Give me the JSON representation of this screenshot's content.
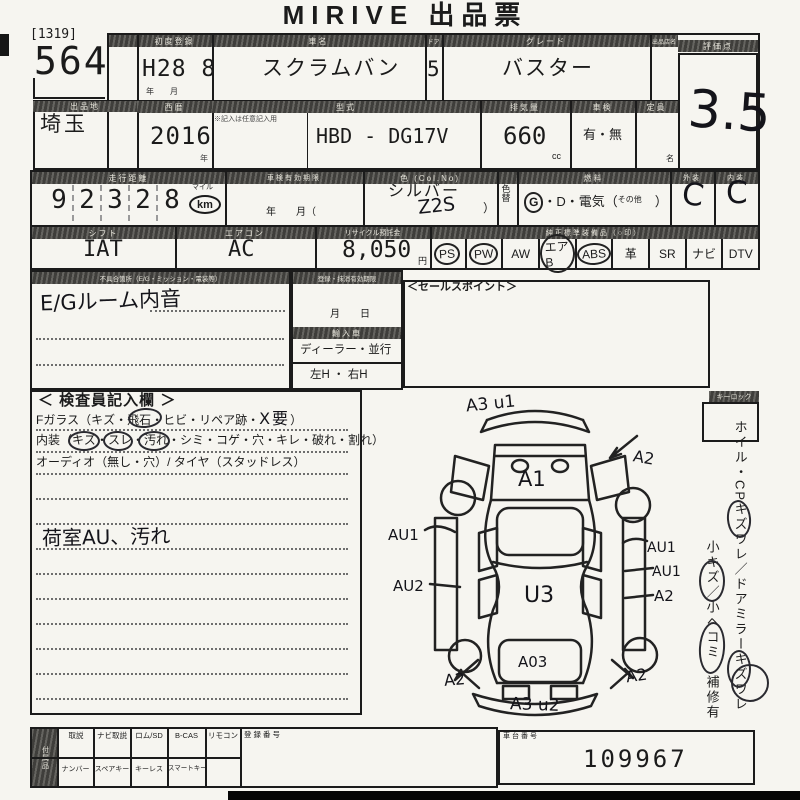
{
  "title": "MIRIVE 出品票",
  "lot": {
    "bracket": "[1319]",
    "number": "564",
    "prefecture_header": "出品地",
    "prefecture": "埼玉"
  },
  "row1": {
    "h_reg": "初度登録",
    "h_name": "車名",
    "h_door": "ドア",
    "h_grade": "グレード",
    "h_seller": "出品店名",
    "h_score": "評価点",
    "reg_value": "H28 8",
    "reg_sub": "年　　月",
    "name_value": "スクラムバン",
    "door_value": "5",
    "grade_value": "バスター",
    "score_value": "3.5"
  },
  "row2": {
    "h_year": "西暦",
    "h_model": "型式",
    "h_cc": "排気量",
    "h_shaken": "車検",
    "h_capacity": "定員",
    "year_value": "2016",
    "year_unit": "年",
    "model_note": "※記入は任意記入用",
    "model_value": "HBD -  DG17V",
    "cc_value": "660",
    "cc_unit": "cc",
    "shaken_value": "有・無",
    "capacity_unit": "名"
  },
  "row3": {
    "h_odo": "走行距離",
    "h_date": "車検有効期限",
    "h_color": "色 (Col.No)",
    "h_fuel": "燃料",
    "h_ext": "外装",
    "h_int": "内装",
    "odo_digits": [
      "9",
      "2",
      "3",
      "2",
      "8"
    ],
    "odo_mile": "マイル",
    "odo_km": "km",
    "date_text": "年　　月（",
    "color_value": "シルバー",
    "color_code": "Z2S",
    "color_paren": "）",
    "repaint": "色替",
    "fuel_g": "G",
    "fuel_mid": "・D・電気（",
    "fuel_other": "その他",
    "fuel_close": "　）",
    "ext_value": "C",
    "int_value": "C"
  },
  "row4": {
    "h_shift": "シフト",
    "h_ac": "エアコン",
    "h_recycle": "リサイクル預託金",
    "h_equip": "純正標準装備品（○印）",
    "shift_value": "IAT",
    "ac_value": "AC",
    "recycle_value": "8,050",
    "recycle_unit": "円",
    "equipment": [
      "PS",
      "PW",
      "AW",
      "エアB",
      "ABS",
      "革",
      "SR",
      "ナビ",
      "DTV"
    ]
  },
  "notes": {
    "header": "不具合箇所（E/G・ミッション・電装等）",
    "hand": "E/Gルーム内音"
  },
  "validity": {
    "header": "登録・抹消有効期限",
    "month_day": "月　　日",
    "h_import": "輸入車",
    "dealer": "ディーラー・並行",
    "handle": "左H ・ 右H"
  },
  "sales": {
    "header": "＜セールスポイント＞"
  },
  "inspector": {
    "title": "＜ 検査員記入欄 ＞",
    "l1a": "Fガラス（キズ・飛石・ヒビ・リペア跡・",
    "l1b": "X要",
    "l1c": "）",
    "l2": "内装（キズ・スレ・汚れ・シミ・コゲ・穴・キレ・破れ・割れ）",
    "l3": "オーディオ（無し・穴）/ タイヤ（スタッドレス）",
    "hand": "荷室AU、汚れ"
  },
  "diagram": {
    "labels": [
      "A3 u1",
      "A1",
      "A2",
      "AU1",
      "AU2",
      "U3",
      "AU1",
      "AU1",
      "A2",
      "A2",
      "A03",
      "A2",
      "A3 u2"
    ]
  },
  "sidebar": {
    "keylock": "キーロック",
    "line1": "ホイル・CPキズワレ／ドアミラーキズワレ",
    "line2": "小キズ／小ヘコミ　補修有"
  },
  "bottom": {
    "side": "付属品",
    "row1": [
      "取説",
      "ナビ取説",
      "ロム/SD",
      "B-CAS",
      "リモコン"
    ],
    "reg_no": "登録番号",
    "row2": [
      "ナンバー",
      "スペアキー",
      "キーレス",
      "スマートキー"
    ],
    "chassis_label": "車台番号",
    "chassis_value": "109967"
  }
}
